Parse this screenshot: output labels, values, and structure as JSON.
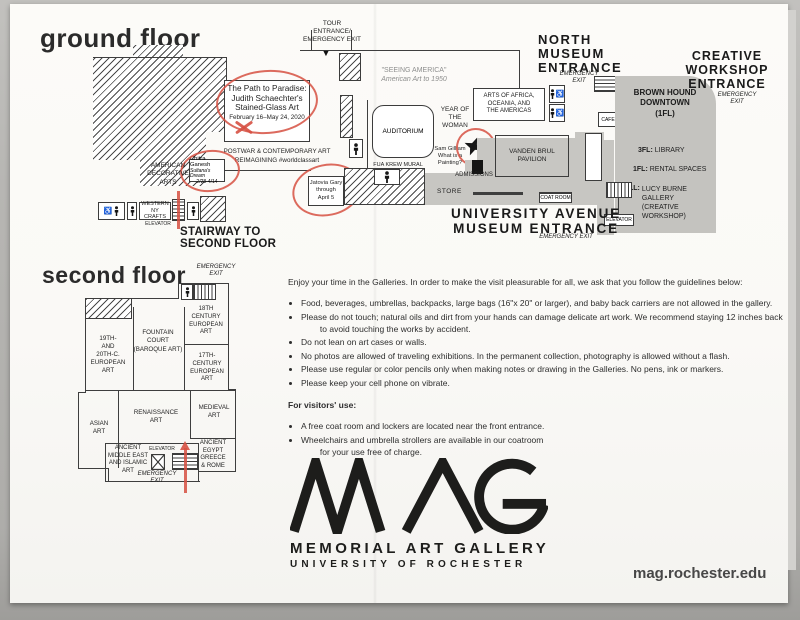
{
  "palette": {
    "annotation_red": "#d65042",
    "map_gray": "#c7c6c2",
    "ink": "#1d1d1b"
  },
  "ground": {
    "title": "ground floor",
    "tour_entrance": "TOUR\nENTRANCE/\nEMERGENCY EXIT",
    "seeing_america_title": "\"SEEING AMERICA\"",
    "seeing_america_sub": "American Art to 1950",
    "path_exhibit": "The Path to Paradise:\nJudith Schaechter's\nStained-Glass Art",
    "path_dates": "February 16–May 24, 2020",
    "postwar": "POSTWAR & CONTEMPORARY ART\nREIMAGINING #worldclassart",
    "chitra_name": "Chitra Ganesh",
    "chitra_work": "Sultana's Dream",
    "chitra_dates": "2/28-4/14",
    "jatovia": "Jatovia Gary\nthrough\nApril 5",
    "american_decorative": "AMERICAN\nDECORATIVE\nARTS",
    "western_ny": "WESTERN NY\nCRAFTS",
    "elevator_left": "ELEVATOR",
    "stairway": "STAIRWAY TO\nSECOND FLOOR",
    "fua_krew": "FUA KREW MURAL",
    "auditorium": "AUDITORIUM",
    "year_of_woman": "YEAR OF\nTHE\nWOMAN",
    "sam_gilliam": "Sam Gilliam\nWhat is a\nPainting?",
    "admissions": "ADMISSIONS",
    "arts_africa": "ARTS OF AFRICA,\nOCEANIA, AND\nTHE AMERICAS",
    "north_entrance": "NORTH\nMUSEUM\nENTRANCE",
    "emergency_exit_north": "EMERGENCY\nEXIT",
    "cafe": "CAFE",
    "brown_hound": "BROWN HOUND\nDOWNTOWN\n(1FL)",
    "fl3_label": "3FL:",
    "fl3_value": "LIBRARY",
    "fl1_label": "1FL:",
    "fl1_value": "RENTAL SPACES",
    "ll_label": "LL:",
    "ll_value": "LUCY BURNE\nGALLERY\n(CREATIVE\nWORKSHOP)",
    "creative_entrance": "CREATIVE\nWORKSHOP\nENTRANCE",
    "emergency_exit_creative": "EMERGENCY\nEXIT",
    "vanden_brul": "VANDEN BRUL\nPAVILION",
    "store": "STORE",
    "coat_room": "COAT ROOM",
    "elevator_right": "ELEVATOR",
    "university_entrance": "UNIVERSITY AVENUE\nMUSEUM ENTRANCE",
    "emergency_exit_university": "EMERGENCY EXIT"
  },
  "second": {
    "title": "second floor",
    "emergency_exit_top": "EMERGENCY\nEXIT",
    "c18": "18TH\nCENTURY\nEUROPEAN\nART",
    "fountain": "FOUNTAIN\nCOURT\n(BAROQUE ART)",
    "c19_20": "19TH-\nAND\n20TH-C.\nEUROPEAN\nART",
    "c17": "17TH-\nCENTURY\nEUROPEAN\nART",
    "asian": "ASIAN\nART",
    "renaissance": "RENAISSANCE\nART",
    "medieval": "MEDIEVAL\nART",
    "ancient_me": "ANCIENT\nMIDDLE EAST\nAND ISLAMIC\nART",
    "elevator": "ELEVATOR",
    "egypt": "ANCIENT\nEGYPT\nGREECE\n& ROME",
    "emergency_exit_bottom": "EMERGENCY\nEXIT"
  },
  "guidelines": {
    "intro": "Enjoy your time in the Galleries. In order to make the visit pleasurable for all, we ask that you follow the guidelines below:",
    "rules": [
      "Food, beverages, umbrellas, backpacks, large bags (16\"x 20\" or larger), and baby back carriers are not allowed in the gallery.",
      "Please do not touch; natural oils and dirt from your hands can damage delicate art work. We recommend staying 12 inches back\n        to avoid touching the works by accident.",
      "Do not lean on art cases or walls.",
      "No photos are allowed of traveling exhibitions. In the permanent collection, photography is allowed without a flash.",
      "Please use regular or color pencils only when making notes or drawing in the Galleries. No pens, ink or markers.",
      "Please keep your cell phone on vibrate."
    ],
    "visitors_title": "For visitors' use:",
    "visitors": [
      "A free coat room and lockers are located near the front entrance.",
      "Wheelchairs and umbrella strollers are available in our coatroom\n        for your use free of charge."
    ]
  },
  "logo": {
    "line1": "MEMORIAL ART GALLERY",
    "line2": "UNIVERSITY OF ROCHESTER"
  },
  "footer": {
    "website": "mag.rochester.edu"
  }
}
